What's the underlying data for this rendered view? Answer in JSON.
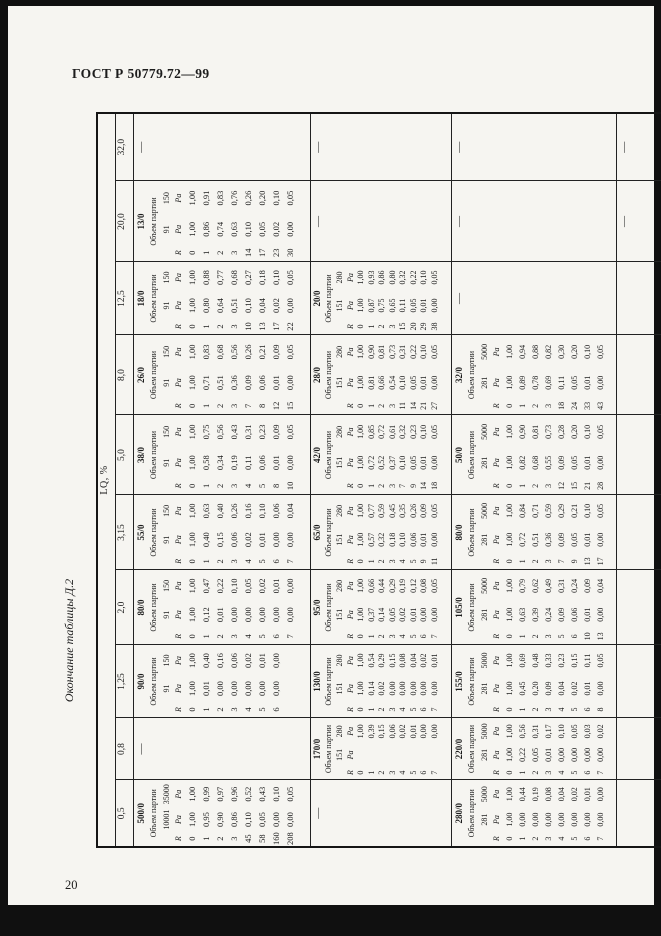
{
  "header": {
    "title": "ГОСТ Р 50779.72—99",
    "caption": "Окончание таблицы Д.2"
  },
  "footer": {
    "page_number": "20"
  },
  "table": {
    "lq_label": "LQ, %",
    "lot_label": "Объем партии",
    "r_label": "R",
    "pa_label": "Pa",
    "dash": "—",
    "col_widths": [
      67,
      62,
      73,
      75,
      75,
      80,
      80,
      73,
      81,
      68
    ],
    "row_heights": [
      15,
      15,
      174,
      138,
      162,
      60
    ],
    "lq_values": [
      "0,5",
      "0,8",
      "1,25",
      "2,0",
      "3,15",
      "5,0",
      "8,0",
      "12,5",
      "20,0",
      "32,0"
    ],
    "grid": [
      {
        "lq": "0,5",
        "cells": [
          "b500",
          "—",
          "b280",
          ""
        ]
      },
      {
        "lq": "0,8",
        "cells": [
          "—",
          "b170",
          "b220",
          ""
        ]
      },
      {
        "lq": "1,25",
        "cells": [
          "b90",
          "b130",
          "b155",
          ""
        ]
      },
      {
        "lq": "2,0",
        "cells": [
          "b80b",
          "b95",
          "b105",
          ""
        ]
      },
      {
        "lq": "3,15",
        "cells": [
          "b55",
          "b65",
          "b80a",
          ""
        ]
      },
      {
        "lq": "5,0",
        "cells": [
          "b38",
          "b42",
          "b50",
          ""
        ]
      },
      {
        "lq": "8,0",
        "cells": [
          "b26",
          "b28",
          "b32",
          ""
        ]
      },
      {
        "lq": "12,5",
        "cells": [
          "b18",
          "b20",
          "—",
          ""
        ]
      },
      {
        "lq": "20,0",
        "cells": [
          "b13",
          "—",
          "—",
          "—"
        ]
      },
      {
        "lq": "32,0",
        "cells": [
          "—",
          "—",
          "—",
          "—"
        ]
      }
    ]
  },
  "blocks": {
    "b500": {
      "code": "500/0",
      "n1": "10001",
      "n2": "35000",
      "rows": [
        [
          "0",
          "1,00",
          "1,00"
        ],
        [
          "1",
          "0,95",
          "0,99"
        ],
        [
          "2",
          "0,90",
          "0,97"
        ],
        [
          "3",
          "0,86",
          "0,96"
        ],
        [
          "45",
          "0,10",
          "0,52"
        ],
        [
          "58",
          "0,05",
          "0,43"
        ],
        [
          "160",
          "0,00",
          "0,10"
        ],
        [
          "208",
          "0,00",
          "0,05"
        ]
      ]
    },
    "b280": {
      "code": "280/0",
      "n1": "281",
      "n2": "5000",
      "rows": [
        [
          "0",
          "1,00",
          "1,00"
        ],
        [
          "1",
          "0,00",
          "0,44"
        ],
        [
          "2",
          "0,00",
          "0,19"
        ],
        [
          "3",
          "0,00",
          "0,08"
        ],
        [
          "4",
          "0,00",
          "0,04"
        ],
        [
          "5",
          "0,00",
          "0,02"
        ],
        [
          "6",
          "0,00",
          "0,01"
        ],
        [
          "7",
          "0,00",
          "0,00"
        ]
      ]
    },
    "b170": {
      "code": "170/0",
      "n1": "151",
      "n2": "280",
      "rows": [
        [
          "0",
          "",
          "1,00"
        ],
        [
          "1",
          "",
          "0,39"
        ],
        [
          "2",
          "",
          "0,15"
        ],
        [
          "3",
          "",
          "0,06"
        ],
        [
          "4",
          "",
          "0,02"
        ],
        [
          "5",
          "",
          "0,01"
        ],
        [
          "6",
          "",
          "0,00"
        ],
        [
          "7",
          "",
          "0,00"
        ]
      ]
    },
    "b220": {
      "code": "220/0",
      "n1": "281",
      "n2": "5000",
      "rows": [
        [
          "0",
          "1,00",
          "1,00"
        ],
        [
          "1",
          "0,22",
          "0,56"
        ],
        [
          "2",
          "0,05",
          "0,31"
        ],
        [
          "3",
          "0,01",
          "0,17"
        ],
        [
          "4",
          "0,00",
          "0,10"
        ],
        [
          "5",
          "0,00",
          "0,05"
        ],
        [
          "6",
          "0,00",
          "0,03"
        ],
        [
          "7",
          "0,00",
          "0,02"
        ]
      ]
    },
    "b90": {
      "code": "90/0",
      "n1": "91",
      "n2": "150",
      "rows": [
        [
          "0",
          "1,00",
          "1,00"
        ],
        [
          "1",
          "0,01",
          "0,40"
        ],
        [
          "2",
          "0,00",
          "0,16"
        ],
        [
          "3",
          "0,00",
          "0,06"
        ],
        [
          "4",
          "0,00",
          "0,02"
        ],
        [
          "5",
          "0,00",
          "0,01"
        ],
        [
          "6",
          "0,00",
          "0,00"
        ]
      ]
    },
    "b130": {
      "code": "130/0",
      "n1": "151",
      "n2": "280",
      "rows": [
        [
          "0",
          "1,00",
          "1,00"
        ],
        [
          "1",
          "0,14",
          "0,54"
        ],
        [
          "2",
          "0,02",
          "0,29"
        ],
        [
          "3",
          "0,00",
          "0,15"
        ],
        [
          "4",
          "0,00",
          "0,08"
        ],
        [
          "5",
          "0,00",
          "0,04"
        ],
        [
          "6",
          "0,00",
          "0,02"
        ],
        [
          "7",
          "0,00",
          "0,01"
        ]
      ]
    },
    "b155": {
      "code": "155/0",
      "n1": "281",
      "n2": "5000",
      "rows": [
        [
          "0",
          "1,00",
          "1,00"
        ],
        [
          "1",
          "0,45",
          "0,69"
        ],
        [
          "2",
          "0,20",
          "0,48"
        ],
        [
          "3",
          "0,09",
          "0,33"
        ],
        [
          "4",
          "0,04",
          "0,23"
        ],
        [
          "5",
          "0,02",
          "0,15"
        ],
        [
          "6",
          "0,01",
          "0,11"
        ],
        [
          "8",
          "0,00",
          "0,05"
        ]
      ]
    },
    "b80b": {
      "code": "80/0",
      "n1": "91",
      "n2": "150",
      "rows": [
        [
          "0",
          "1,00",
          "1,00"
        ],
        [
          "1",
          "0,12",
          "0,47"
        ],
        [
          "2",
          "0,01",
          "0,22"
        ],
        [
          "3",
          "0,00",
          "0,10"
        ],
        [
          "4",
          "0,00",
          "0,05"
        ],
        [
          "5",
          "0,00",
          "0,02"
        ],
        [
          "6",
          "0,00",
          "0,01"
        ],
        [
          "7",
          "0,00",
          "0,00"
        ]
      ]
    },
    "b95": {
      "code": "95/0",
      "n1": "151",
      "n2": "280",
      "rows": [
        [
          "0",
          "1,00",
          "1,00"
        ],
        [
          "1",
          "0,37",
          "0,66"
        ],
        [
          "2",
          "0,14",
          "0,44"
        ],
        [
          "3",
          "0,05",
          "0,29"
        ],
        [
          "4",
          "0,02",
          "0,19"
        ],
        [
          "5",
          "0,01",
          "0,12"
        ],
        [
          "6",
          "0,00",
          "0,08"
        ],
        [
          "7",
          "0,00",
          "0,05"
        ]
      ]
    },
    "b105": {
      "code": "105/0",
      "n1": "281",
      "n2": "5000",
      "rows": [
        [
          "0",
          "1,00",
          "1,00"
        ],
        [
          "1",
          "0,63",
          "0,79"
        ],
        [
          "2",
          "0,39",
          "0,62"
        ],
        [
          "3",
          "0,24",
          "0,49"
        ],
        [
          "5",
          "0,09",
          "0,31"
        ],
        [
          "6",
          "0,06",
          "0,24"
        ],
        [
          "10",
          "0,01",
          "0,09"
        ],
        [
          "13",
          "0,00",
          "0,04"
        ]
      ]
    },
    "b55": {
      "code": "55/0",
      "n1": "91",
      "n2": "150",
      "rows": [
        [
          "0",
          "1,00",
          "1,00"
        ],
        [
          "1",
          "0,40",
          "0,63"
        ],
        [
          "2",
          "0,15",
          "0,40"
        ],
        [
          "3",
          "0,06",
          "0,26"
        ],
        [
          "4",
          "0,02",
          "0,16"
        ],
        [
          "5",
          "0,01",
          "0,10"
        ],
        [
          "6",
          "0,00",
          "0,06"
        ],
        [
          "7",
          "0,00",
          "0,04"
        ]
      ]
    },
    "b65": {
      "code": "65/0",
      "n1": "151",
      "n2": "280",
      "rows": [
        [
          "0",
          "1,00",
          "1,00"
        ],
        [
          "1",
          "0,57",
          "0,77"
        ],
        [
          "2",
          "0,32",
          "0,59"
        ],
        [
          "3",
          "0,18",
          "0,45"
        ],
        [
          "4",
          "0,10",
          "0,35"
        ],
        [
          "5",
          "0,06",
          "0,26"
        ],
        [
          "9",
          "0,01",
          "0,09"
        ],
        [
          "11",
          "0,00",
          "0,05"
        ]
      ]
    },
    "b80a": {
      "code": "80/0",
      "n1": "281",
      "n2": "5000",
      "rows": [
        [
          "0",
          "1,00",
          "1,00"
        ],
        [
          "1",
          "0,72",
          "0,84"
        ],
        [
          "2",
          "0,51",
          "0,71"
        ],
        [
          "3",
          "0,36",
          "0,59"
        ],
        [
          "7",
          "0,09",
          "0,29"
        ],
        [
          "9",
          "0,05",
          "0,21"
        ],
        [
          "13",
          "0,01",
          "0,10"
        ],
        [
          "17",
          "0,00",
          "0,05"
        ]
      ]
    },
    "b38": {
      "code": "38/0",
      "n1": "91",
      "n2": "150",
      "rows": [
        [
          "0",
          "1,00",
          "1,00"
        ],
        [
          "1",
          "0,58",
          "0,75"
        ],
        [
          "2",
          "0,34",
          "0,56"
        ],
        [
          "3",
          "0,19",
          "0,43"
        ],
        [
          "4",
          "0,11",
          "0,31"
        ],
        [
          "5",
          "0,06",
          "0,23"
        ],
        [
          "8",
          "0,01",
          "0,09"
        ],
        [
          "10",
          "0,00",
          "0,05"
        ]
      ]
    },
    "b42": {
      "code": "42/0",
      "n1": "151",
      "n2": "280",
      "rows": [
        [
          "0",
          "1,00",
          "1,00"
        ],
        [
          "1",
          "0,72",
          "0,85"
        ],
        [
          "2",
          "0,52",
          "0,72"
        ],
        [
          "3",
          "0,37",
          "0,61"
        ],
        [
          "7",
          "0,10",
          "0,32"
        ],
        [
          "9",
          "0,05",
          "0,23"
        ],
        [
          "14",
          "0,01",
          "0,10"
        ],
        [
          "18",
          "0,00",
          "0,05"
        ]
      ]
    },
    "b50": {
      "code": "50/0",
      "n1": "281",
      "n2": "5000",
      "rows": [
        [
          "0",
          "1,00",
          "1,00"
        ],
        [
          "1",
          "0,82",
          "0,90"
        ],
        [
          "2",
          "0,68",
          "0,81"
        ],
        [
          "3",
          "0,55",
          "0,73"
        ],
        [
          "12",
          "0,09",
          "0,28"
        ],
        [
          "15",
          "0,05",
          "0,20"
        ],
        [
          "21",
          "0,01",
          "0,10"
        ],
        [
          "28",
          "0,00",
          "0,05"
        ]
      ]
    },
    "b26": {
      "code": "26/0",
      "n1": "91",
      "n2": "150",
      "rows": [
        [
          "0",
          "1,00",
          "1,00"
        ],
        [
          "1",
          "0,71",
          "0,83"
        ],
        [
          "2",
          "0,51",
          "0,68"
        ],
        [
          "3",
          "0,36",
          "0,56"
        ],
        [
          "7",
          "0,09",
          "0,26"
        ],
        [
          "8",
          "0,06",
          "0,21"
        ],
        [
          "12",
          "0,01",
          "0,09"
        ],
        [
          "15",
          "0,00",
          "0,05"
        ]
      ]
    },
    "b28": {
      "code": "28/0",
      "n1": "151",
      "n2": "280",
      "rows": [
        [
          "0",
          "1,00",
          "1,00"
        ],
        [
          "1",
          "0,81",
          "0,90"
        ],
        [
          "2",
          "0,66",
          "0,81"
        ],
        [
          "3",
          "0,54",
          "0,73"
        ],
        [
          "11",
          "0,10",
          "0,31"
        ],
        [
          "14",
          "0,05",
          "0,22"
        ],
        [
          "21",
          "0,01",
          "0,10"
        ],
        [
          "27",
          "0,00",
          "0,05"
        ]
      ]
    },
    "b32": {
      "code": "32/0",
      "n1": "281",
      "n2": "5000",
      "rows": [
        [
          "0",
          "1,00",
          "1,00"
        ],
        [
          "1",
          "0,89",
          "0,94"
        ],
        [
          "2",
          "0,78",
          "0,88"
        ],
        [
          "3",
          "0,69",
          "0,82"
        ],
        [
          "18",
          "0,11",
          "0,30"
        ],
        [
          "24",
          "0,05",
          "0,20"
        ],
        [
          "33",
          "0,01",
          "0,10"
        ],
        [
          "43",
          "0,00",
          "0,05"
        ]
      ]
    },
    "b18": {
      "code": "18/0",
      "n1": "91",
      "n2": "150",
      "rows": [
        [
          "0",
          "1,00",
          "1,00"
        ],
        [
          "1",
          "0,80",
          "0,88"
        ],
        [
          "2",
          "0,64",
          "0,77"
        ],
        [
          "3",
          "0,51",
          "0,68"
        ],
        [
          "10",
          "0,10",
          "0,27"
        ],
        [
          "13",
          "0,04",
          "0,18"
        ],
        [
          "17",
          "0,02",
          "0,10"
        ],
        [
          "22",
          "0,00",
          "0,05"
        ]
      ]
    },
    "b20": {
      "code": "20/0",
      "n1": "151",
      "n2": "280",
      "rows": [
        [
          "0",
          "1,00",
          "1,00"
        ],
        [
          "1",
          "0,87",
          "0,93"
        ],
        [
          "2",
          "0,75",
          "0,86"
        ],
        [
          "3",
          "0,65",
          "0,80"
        ],
        [
          "15",
          "0,11",
          "0,32"
        ],
        [
          "20",
          "0,05",
          "0,22"
        ],
        [
          "29",
          "0,01",
          "0,10"
        ],
        [
          "38",
          "0,00",
          "0,05"
        ]
      ]
    },
    "b13": {
      "code": "13/0",
      "n1": "91",
      "n2": "150",
      "rows": [
        [
          "0",
          "1,00",
          "1,00"
        ],
        [
          "1",
          "0,86",
          "0,91"
        ],
        [
          "2",
          "0,74",
          "0,83"
        ],
        [
          "3",
          "0,63",
          "0,76"
        ],
        [
          "14",
          "0,10",
          "0,26"
        ],
        [
          "17",
          "0,05",
          "0,20"
        ],
        [
          "23",
          "0,02",
          "0,10"
        ],
        [
          "30",
          "0,00",
          "0,05"
        ]
      ]
    }
  }
}
